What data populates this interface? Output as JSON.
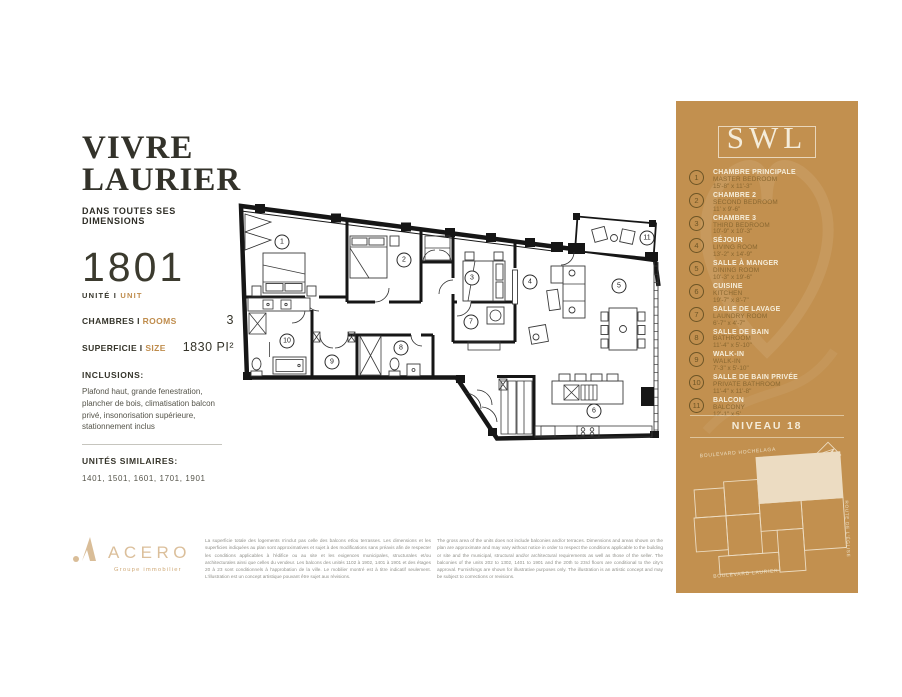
{
  "brand_colors": {
    "sidebar_bg": "#c2904f",
    "cream": "#f4ecda",
    "accent_tan": "#bf8c4c",
    "ink": "#35342a"
  },
  "project": {
    "title_line1": "VIVRE",
    "title_line2": "LAURIER",
    "tagline": "DANS TOUTES SES DIMENSIONS"
  },
  "unit": {
    "number": "1801",
    "unit_label": {
      "fr": "UNITÉ",
      "sep": "I",
      "en": "UNIT"
    },
    "specs": [
      {
        "fr": "CHAMBRES",
        "sep": "I",
        "en": "ROOMS",
        "value": "3"
      },
      {
        "fr": "SUPERFICIE",
        "sep": "I",
        "en": "SIZE",
        "value": "1830 PI²"
      }
    ],
    "inclusions": {
      "title": "INCLUSIONS:",
      "text": "Plafond haut, grande fenestration, plancher de bois, climatisation balcon privé, insonorisation supérieure, stationnement inclus"
    },
    "similar": {
      "title": "UNITÉS SIMILAIRES:",
      "text": "1401, 1501, 1601, 1701, 1901"
    }
  },
  "sidebar": {
    "logo": "SWL",
    "level": "NIVEAU 18",
    "legend": [
      {
        "num": "1",
        "fr": "CHAMBRE PRINCIPALE",
        "en": "MASTER BEDROOM",
        "dim": "15'-8\" x 11'-3\""
      },
      {
        "num": "2",
        "fr": "CHAMBRE 2",
        "en": "SECOND BEDROOM",
        "dim": "11' x 9'-6\""
      },
      {
        "num": "3",
        "fr": "CHAMBRE 3",
        "en": "THIRD BEDROOM",
        "dim": "10'-9\" x 10'-3\""
      },
      {
        "num": "4",
        "fr": "SÉJOUR",
        "en": "LIVING ROOM",
        "dim": "13'-2\" x 14'-9\""
      },
      {
        "num": "5",
        "fr": "SALLE À MANGER",
        "en": "DINING ROOM",
        "dim": "10'-3\" x 19'-6\""
      },
      {
        "num": "6",
        "fr": "CUISINE",
        "en": "KITCHEN",
        "dim": "19'-7\" x 8'-7\""
      },
      {
        "num": "7",
        "fr": "SALLE DE LAVAGE",
        "en": "LAUNDRY ROOM",
        "dim": "6'-7\" x 4'-7\""
      },
      {
        "num": "8",
        "fr": "SALLE DE BAIN",
        "en": "BATHROOM",
        "dim": "11'-4\" x 5'-10\""
      },
      {
        "num": "9",
        "fr": "WALK-IN",
        "en": "WALK-IN",
        "dim": "7'-3\" x 5'-10\""
      },
      {
        "num": "10",
        "fr": "SALLE DE BAIN PRIVÉE",
        "en": "PRIVATE BATHROOM",
        "dim": "11'-4\" x 11'-8\""
      },
      {
        "num": "11",
        "fr": "BALCON",
        "en": "BALCONY",
        "dim": "12'-1\" x 5'"
      }
    ],
    "map": {
      "street_top": "BOULEVARD HOCHELAGA",
      "street_bottom": "BOULEVARD LAURIER",
      "street_right": "ROUTE DE L'ÉGLISE"
    }
  },
  "footer": {
    "brand": "ACERO",
    "brand_sub": "Groupe immobilier",
    "disclaimer_fr": "La superficie totale des logements n'inclut pas celle des balcons et/ou terrasses. Les dimensions et les superficies indiquées au plan sont approximatives et sujet à des modifications sans préavis afin de respecter les conditions applicables à l'édifice ou au site et les exigences municipales, structurales et/ou architecturales ainsi que celles du vendeur. Les balcons des unités 1102 à 1902, 1401 à 1901 et des étages 20 à 23 sont conditionnels à l'approbation de la ville. Le mobilier montré est à titre indicatif seulement. L'illustration est un concept artistique pouvant être sujet aux révisions.",
    "disclaimer_en": "The gross area of the units does not include balconies and/or terraces. Dimensions and areas shown on the plan are approximate and may vary without notice in order to respect the conditions applicable to the building or site and the municipal, structural and/or architectural requirements as well as those of the seller. The balconies of the units 202 to 1302, 1401 to 1901 and the 20th to 23rd floors are conditional to the city's approval. Furnishings are shown for illustrative purposes only. The illustration is an artistic concept and may be subject to corrections or revisions."
  }
}
